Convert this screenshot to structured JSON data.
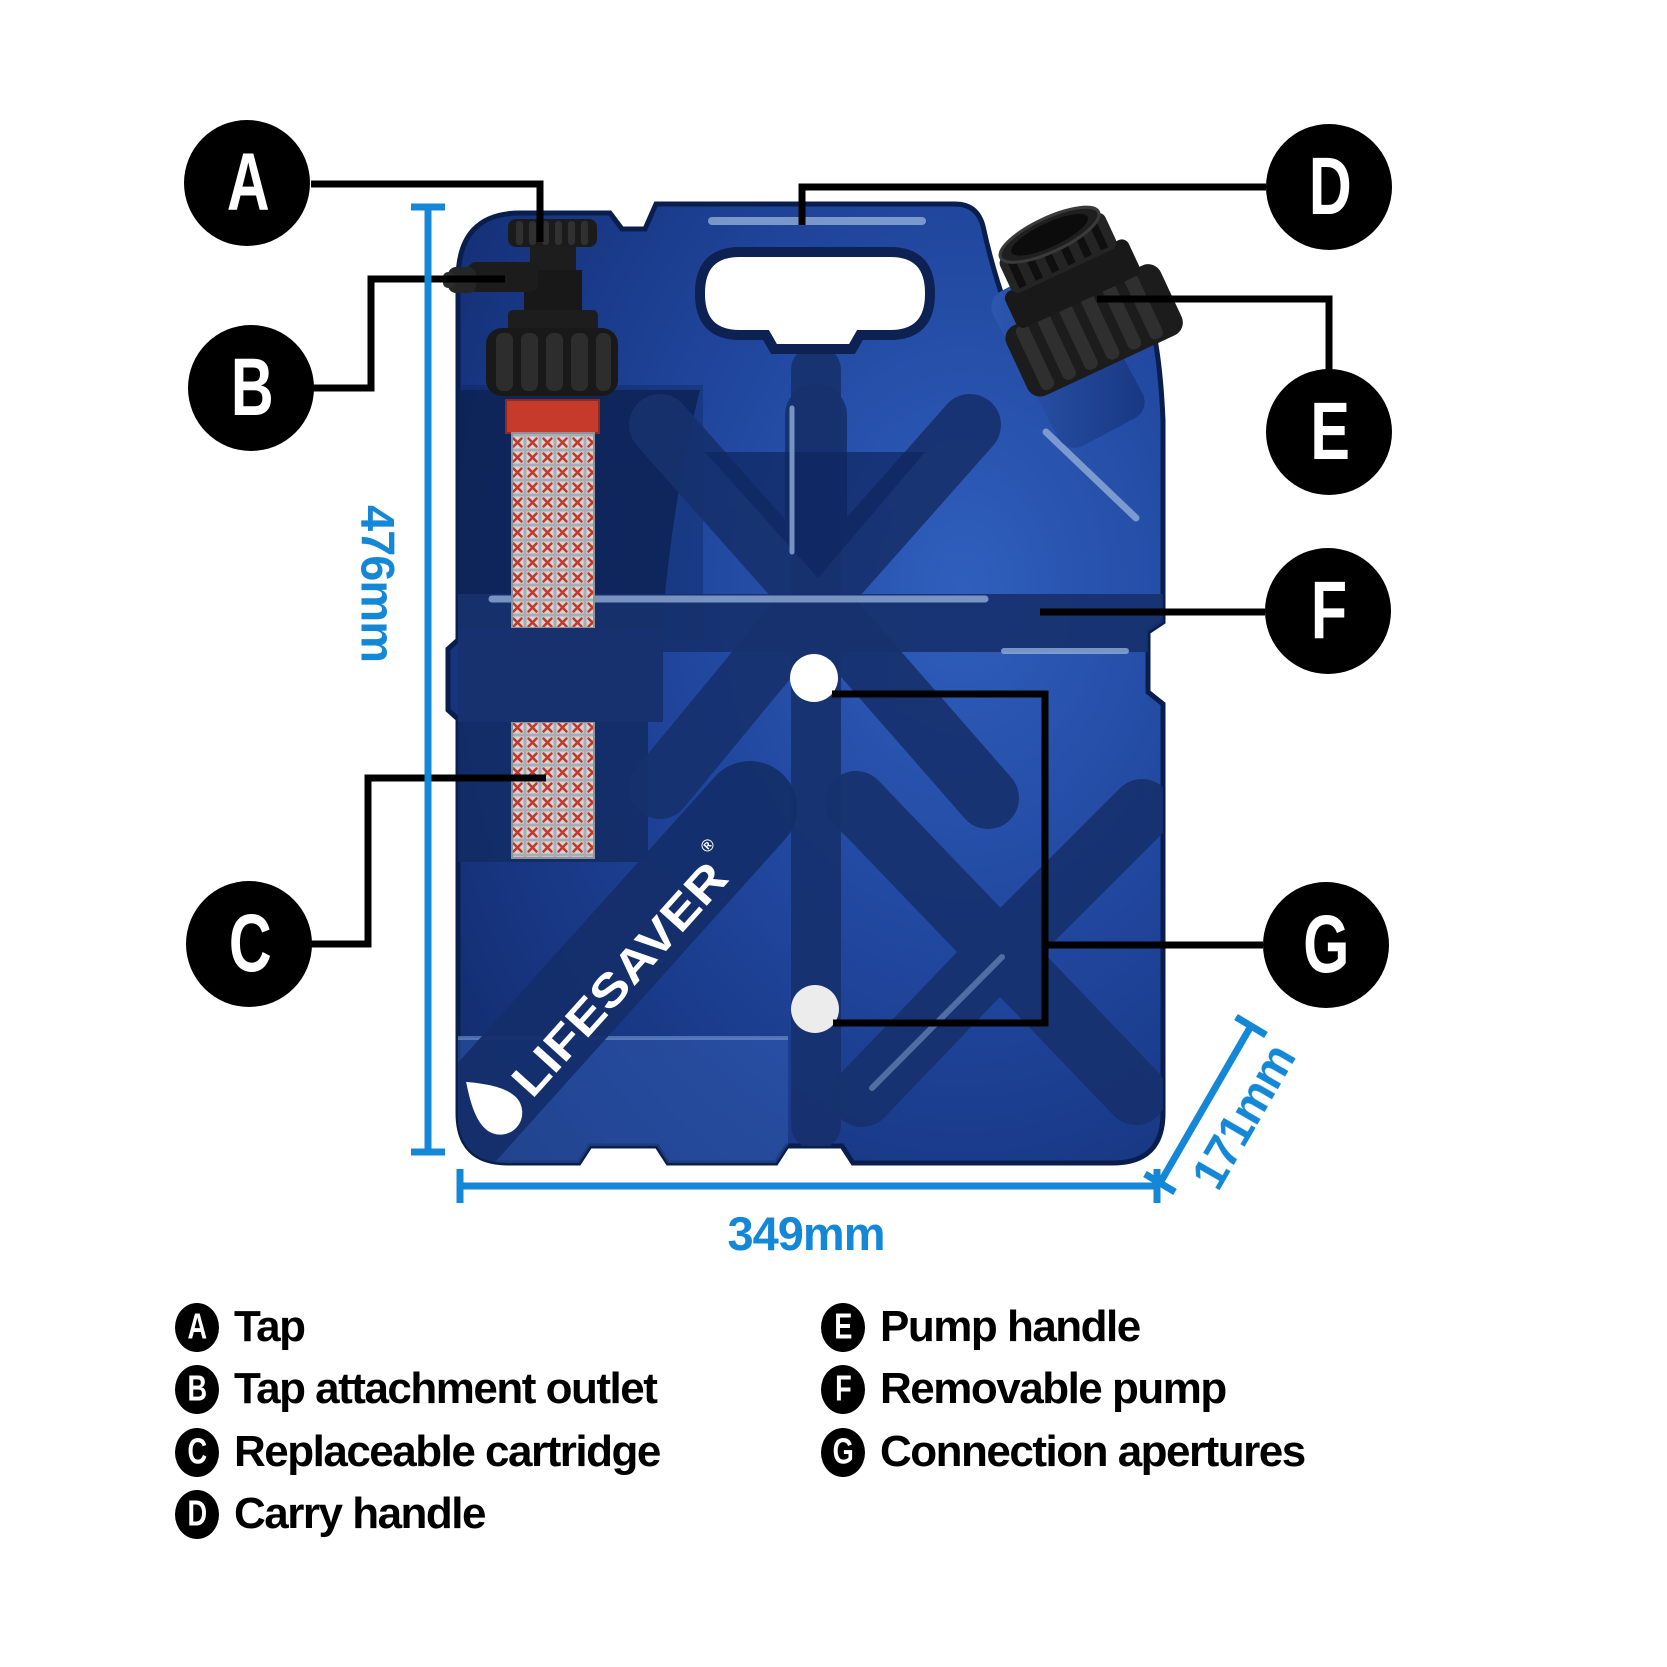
{
  "page": {
    "type": "product-feature-and-dimension-diagram",
    "product": "LIFESAVER jerrycan water purifier"
  },
  "brand": {
    "wordmark": "LIFESAVER",
    "registered_mark": "®"
  },
  "markers": {
    "a": "A",
    "b": "B",
    "c": "C",
    "d": "D",
    "e": "E",
    "f": "F",
    "g": "G"
  },
  "dimensions": {
    "height": "476mm",
    "width": "349mm",
    "depth": "171mm"
  },
  "legend": {
    "left": [
      {
        "letter": "A",
        "label": "Tap"
      },
      {
        "letter": "B",
        "label": "Tap attachment outlet"
      },
      {
        "letter": "C",
        "label": "Replaceable cartridge"
      },
      {
        "letter": "D",
        "label": "Carry handle"
      }
    ],
    "right": [
      {
        "letter": "E",
        "label": "Pump handle"
      },
      {
        "letter": "F",
        "label": "Removable pump"
      },
      {
        "letter": "G",
        "label": "Connection apertures"
      }
    ]
  },
  "colors": {
    "body_blue": "#1e4398",
    "accent_dimension_blue": "#1488d6",
    "cartridge_red": "#c63a2c",
    "callout_black": "#000000",
    "aperture_white": "#ffffff"
  }
}
